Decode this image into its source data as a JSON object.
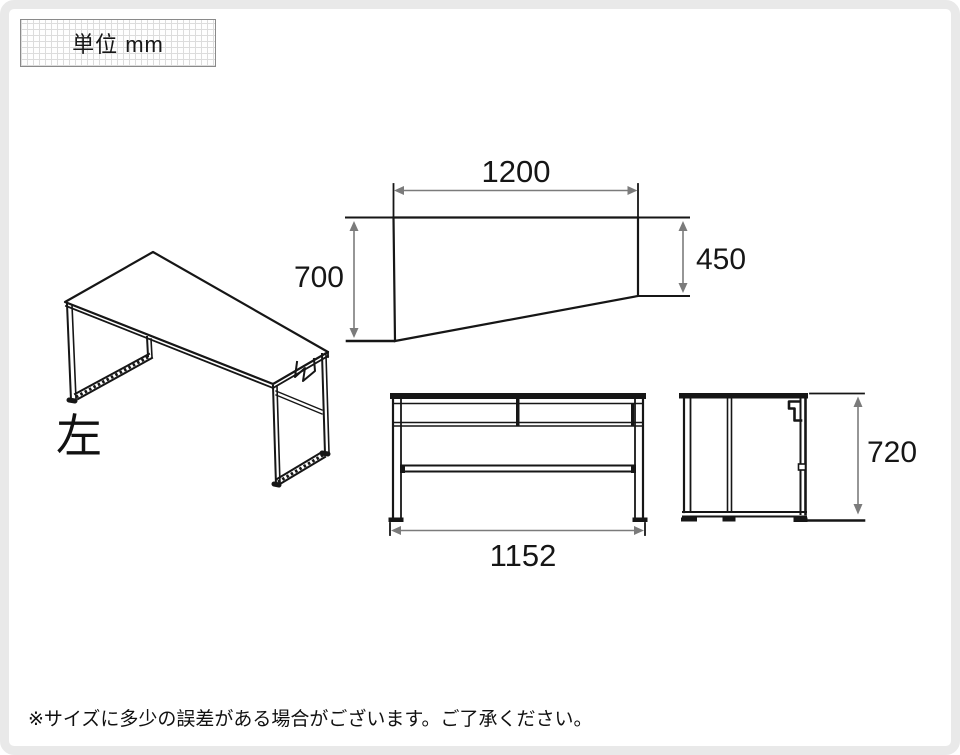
{
  "unit_box": {
    "label": "単位 mm"
  },
  "perspective_view": {
    "label": "左"
  },
  "dimensions": {
    "top_width": "1200",
    "depth_left": "700",
    "depth_right": "450",
    "frame_width": "1152",
    "frame_height": "720"
  },
  "note": "※サイズに多少の誤差がある場合がございます。ご了承ください。",
  "colors": {
    "line": "#161616",
    "dimension_line": "#7b7b7b",
    "page_frame": "#e9e9e9",
    "grid_line": "#dcdcdc"
  }
}
